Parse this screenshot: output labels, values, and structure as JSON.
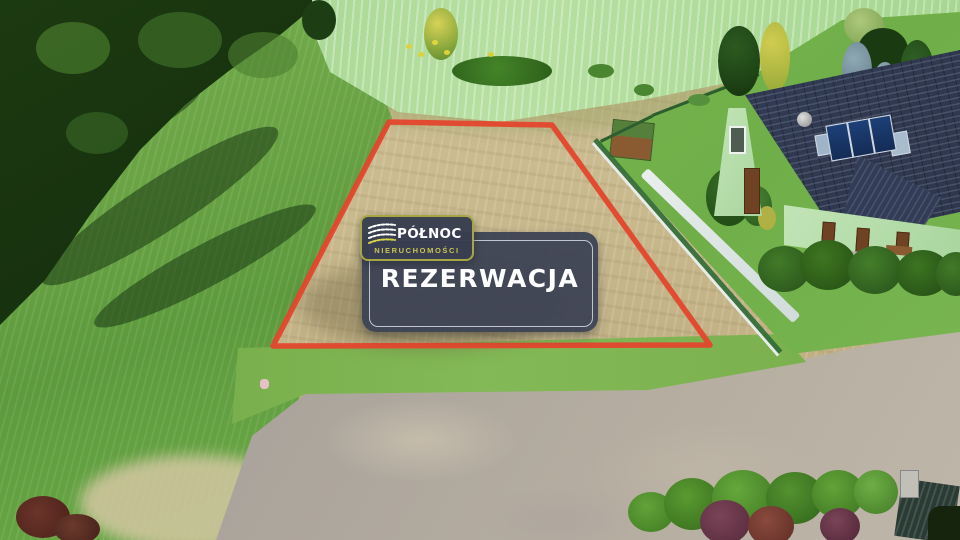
{
  "overlay": {
    "logo": {
      "company": "PÓŁNOC",
      "subtitle": "NIERUCHOMOŚCI"
    },
    "status_label": "REZERWACJA"
  },
  "colors": {
    "plot_outline": "#e2472e",
    "badge_background": "#3b4254",
    "badge_inner_border": "#c9ced6",
    "logo_border": "#a8a644",
    "logo_subtitle_text": "#c9c452",
    "label_text": "#ffffff"
  },
  "icons": {
    "logo_icon": "dashed-arc-lines-logo-icon"
  }
}
